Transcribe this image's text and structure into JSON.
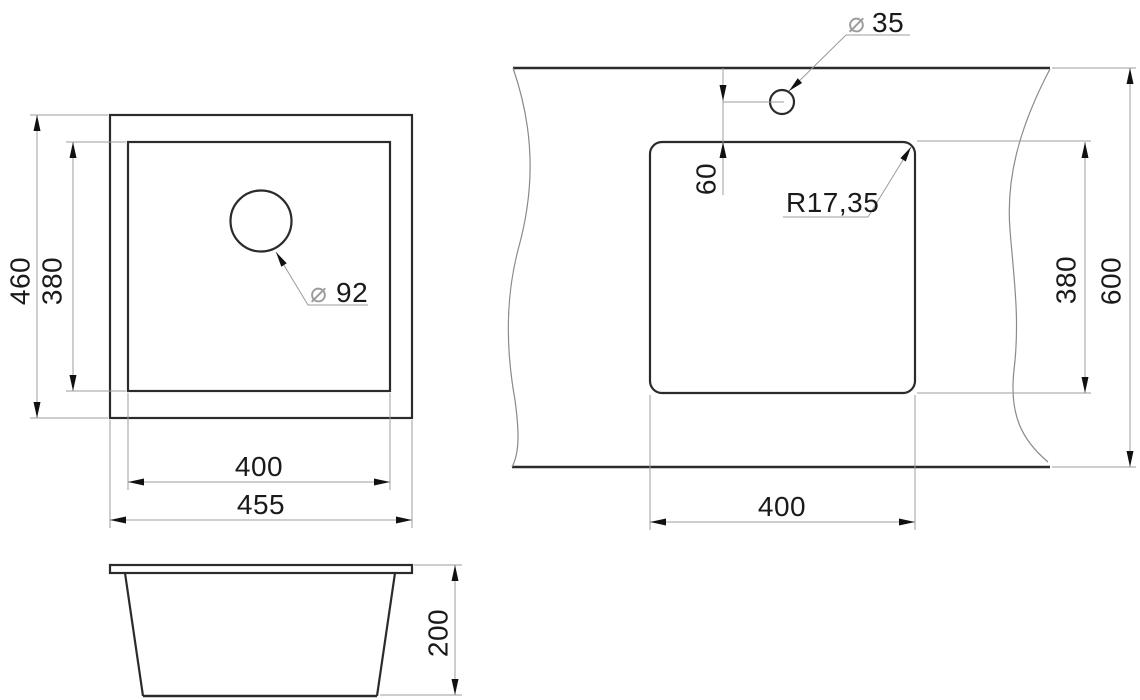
{
  "drawing": {
    "type": "technical-drawing",
    "subject": "kitchen sink dimension drawing with top view, side view and countertop cutout template",
    "colors": {
      "object_line": "#2b2b2b",
      "dim_line": "#9c9c9c",
      "text": "#1a1a1a",
      "background": "#ffffff"
    },
    "top_view": {
      "outer_height": "460",
      "inner_height": "380",
      "drain_symbol": "⌀",
      "drain_diameter": "92",
      "inner_width": "400",
      "outer_width": "455"
    },
    "side_view": {
      "height": "200"
    },
    "cutout_view": {
      "hole_symbol": "⌀",
      "hole_diameter": "35",
      "hole_offset": "60",
      "corner_radius": "R17,35",
      "cutout_height": "380",
      "counter_depth": "600",
      "cutout_width": "400"
    }
  }
}
